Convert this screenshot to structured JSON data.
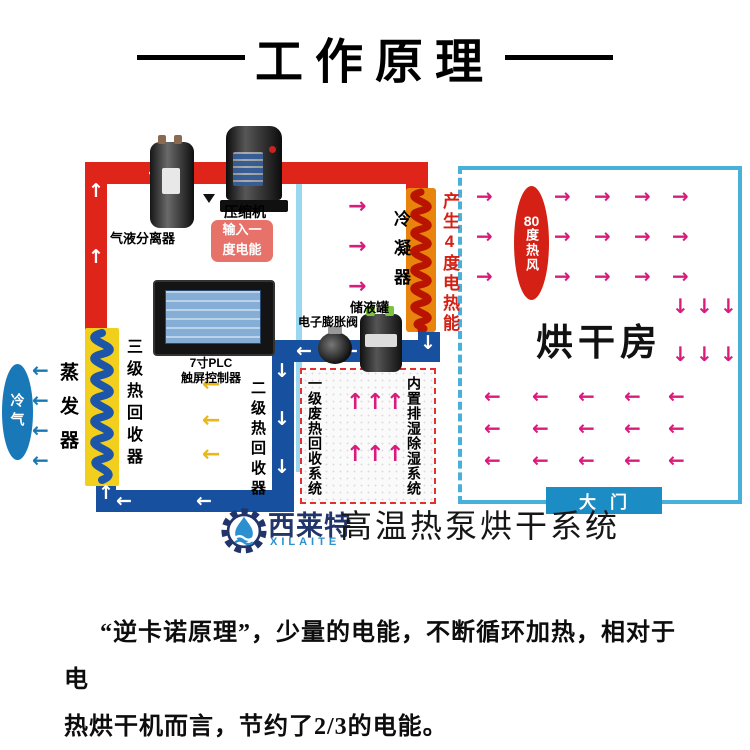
{
  "title": "工作原理",
  "colors": {
    "pipe_red": "#df241a",
    "pipe_blue": "#17509e",
    "wall_blue": "#9ad8f0",
    "room_border": "#49b0da",
    "magenta": "#d81b7c",
    "yellow_arrow": "#e7b81a",
    "blue_arrow": "#1878b4",
    "condenser_orange": "#e8830c",
    "coil_red": "#b81400",
    "coil_blue": "#1d55a8",
    "recovery_yellow": "#f2cf1d",
    "hot_red": "#d42015",
    "cold_blue": "#1878b8",
    "door_blue": "#1b8cc4",
    "badge_red": "#e2544a",
    "logo_navy": "#22356b",
    "logo_blue": "#2b8fd0"
  },
  "diagram": {
    "separator_label": "气液分离器",
    "compressor_label": "压缩机",
    "input_badge": {
      "line1": "输入一",
      "line2": "度电能"
    },
    "condenser_label": "冷凝器",
    "heat_output_label": "产生4度电热能",
    "plc_label": {
      "line1": "7寸PLC",
      "line2": "触屏控制器"
    },
    "tank_label": "储液罐",
    "valve_label": "电子膨胀阀",
    "evaporator_label": "蒸发器",
    "cold_air_label": "冷气",
    "recovery3_label": "三级热回收器",
    "recovery2_label": "二级热回收器",
    "recovery1_label": "一级废热回收系统",
    "dehumidifier_label": "内置排湿除湿系统",
    "hot_wind": {
      "num": "80",
      "chars": "度热风"
    },
    "room_label": "烘干房",
    "door_label": "大门"
  },
  "logo": {
    "brand_cn": "西莱特",
    "brand_en": "XILAITE",
    "product": "高温热泵烘干系统"
  },
  "caption": {
    "line1": "“逆卡诺原理”，少量的电能，不断循环加热，相对于电",
    "line2": "热烘干机而言，节约了2/3的电能。"
  }
}
